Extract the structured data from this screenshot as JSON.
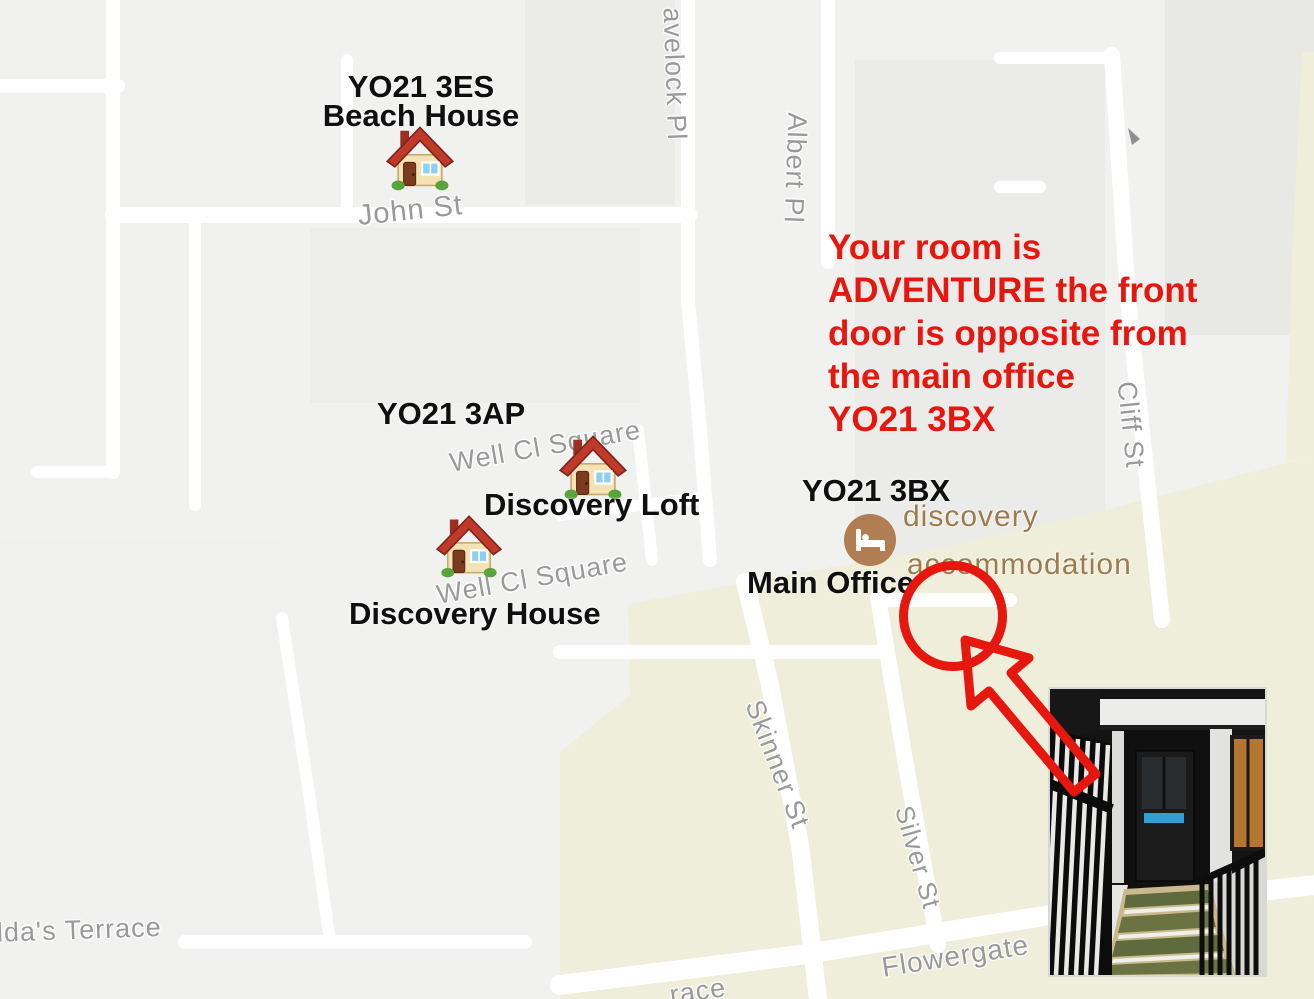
{
  "map": {
    "markers": {
      "beach_house": {
        "postcode": "YO21 3ES",
        "name": "Beach House",
        "icon": "house-icon"
      },
      "discovery_loft": {
        "postcode": "YO21 3AP",
        "name": "Discovery Loft",
        "icon": "house-icon"
      },
      "discovery_house": {
        "name": "Discovery House",
        "icon": "house-icon"
      },
      "main_office": {
        "postcode": "YO21 3BX",
        "name": "Main Office",
        "icon": "bed-icon"
      }
    },
    "poi": {
      "line1": "discovery",
      "line2": "accommodation"
    },
    "streets": {
      "john": "John St",
      "havelock": "avelock Pl",
      "albert": "Albert Pl",
      "cliff": "Cliff St",
      "well_upper": "Well Cl Square",
      "well_lower": "Well Cl Square",
      "skinner": "Skinner St",
      "silver": "Silver St",
      "flowergate": "Flowergate",
      "hilda": "ilda's Terrace",
      "partial_bottom": "race"
    }
  },
  "annotation": {
    "note": {
      "line1": "Your room is",
      "line2": "ADVENTURE the front",
      "line3": "door is opposite from",
      "line4": "the main office",
      "line5": "YO21 3BX"
    }
  },
  "colors": {
    "annotation_red": "#e5170e",
    "map_background": "#f1f1f0",
    "road": "#ffffff",
    "block_gray": "#ebebe8",
    "commercial_area": "#eeeedb",
    "street_label": "#999999",
    "marker_label": "#0f0f0f",
    "poi_brown": "#9c7b4d",
    "poi_icon_brown": "#b07e52"
  }
}
